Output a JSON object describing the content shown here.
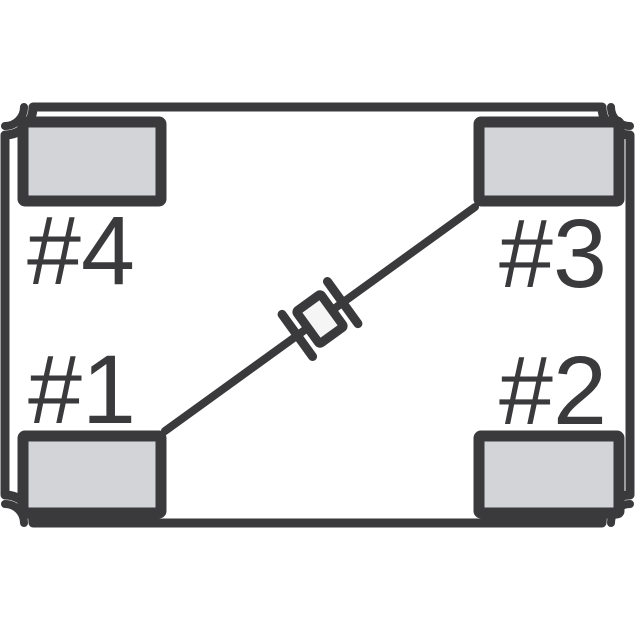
{
  "figure": {
    "type": "component-pinout-diagram",
    "description": "Top view of a 4-pad SMD crystal package showing corner castellations, four terminal pads and the internal crystal element connected diagonally between pad #1 and pad #3",
    "pads": [
      {
        "id": 1,
        "label": "#1",
        "position": "bottom-left"
      },
      {
        "id": 2,
        "label": "#2",
        "position": "bottom-right"
      },
      {
        "id": 3,
        "label": "#3",
        "position": "top-right"
      },
      {
        "id": 4,
        "label": "#4",
        "position": "top-left"
      }
    ],
    "connection": {
      "from_pad": "#1",
      "to_pad": "#3",
      "through": "crystal-element-symbol"
    },
    "colors": {
      "outline": "#3a3a3c",
      "pad_fill": "#d3d4d7",
      "crystal_fill": "#f5f5f5",
      "background": "#ffffff"
    }
  }
}
